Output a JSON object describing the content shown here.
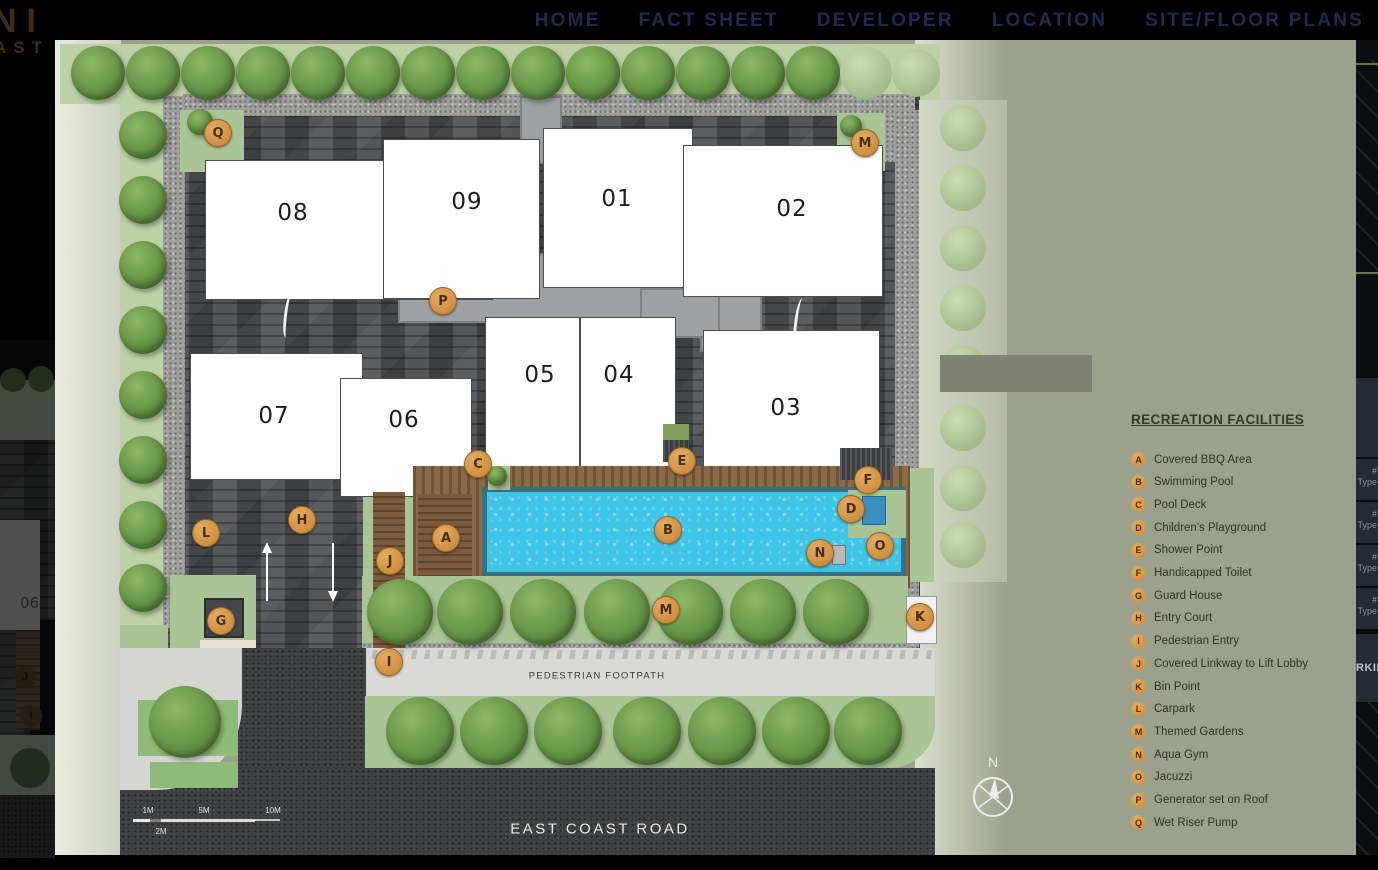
{
  "nav": {
    "items": [
      {
        "label": "HOME"
      },
      {
        "label": "FACT SHEET"
      },
      {
        "label": "DEVELOPER"
      },
      {
        "label": "LOCATION"
      },
      {
        "label": "SITE/FLOOR PLANS"
      }
    ]
  },
  "logo": {
    "top": "NI",
    "bottom": "AST"
  },
  "legend": {
    "title": "RECREATION FACILITIES",
    "items": [
      {
        "key": "A",
        "label": "Covered BBQ Area"
      },
      {
        "key": "B",
        "label": "Swimming Pool"
      },
      {
        "key": "C",
        "label": "Pool Deck"
      },
      {
        "key": "D",
        "label": "Children's Playground"
      },
      {
        "key": "E",
        "label": "Shower Point"
      },
      {
        "key": "F",
        "label": "Handicapped Toilet"
      },
      {
        "key": "G",
        "label": "Guard House"
      },
      {
        "key": "H",
        "label": "Entry Court"
      },
      {
        "key": "I",
        "label": "Pedestrian Entry"
      },
      {
        "key": "J",
        "label": "Covered Linkway to Lift Lobby"
      },
      {
        "key": "K",
        "label": "Bin Point"
      },
      {
        "key": "L",
        "label": "Carpark"
      },
      {
        "key": "M",
        "label": "Themed Gardens"
      },
      {
        "key": "N",
        "label": "Aqua Gym"
      },
      {
        "key": "O",
        "label": "Jacuzzi"
      },
      {
        "key": "P",
        "label": "Generator set on Roof"
      },
      {
        "key": "Q",
        "label": "Wet Riser Pump"
      }
    ]
  },
  "site_plan": {
    "buildings": [
      {
        "num": "08",
        "x": 205,
        "y": 160,
        "w": 288,
        "h": 140,
        "lx": 293,
        "ly": 213
      },
      {
        "num": "09",
        "x": 383,
        "y": 139,
        "w": 157,
        "h": 160,
        "lx": 467,
        "ly": 202
      },
      {
        "num": "01",
        "x": 543,
        "y": 128,
        "w": 150,
        "h": 160,
        "lx": 617,
        "ly": 199
      },
      {
        "num": "02",
        "x": 683,
        "y": 145,
        "w": 200,
        "h": 152,
        "lx": 792,
        "ly": 209
      },
      {
        "num": "07",
        "x": 190,
        "y": 353,
        "w": 173,
        "h": 127,
        "lx": 274,
        "ly": 416
      },
      {
        "num": "06",
        "x": 340,
        "y": 378,
        "w": 132,
        "h": 119,
        "lx": 404,
        "ly": 420
      },
      {
        "num": "05",
        "x": 485,
        "y": 317,
        "w": 95,
        "h": 183,
        "lx": 540,
        "ly": 375
      },
      {
        "num": "04",
        "x": 580,
        "y": 317,
        "w": 96,
        "h": 183,
        "lx": 619,
        "ly": 375
      },
      {
        "num": "03",
        "x": 703,
        "y": 330,
        "w": 177,
        "h": 148,
        "lx": 786,
        "ly": 408
      }
    ],
    "markers": [
      {
        "key": "Q",
        "x": 218,
        "y": 133
      },
      {
        "key": "M",
        "x": 865,
        "y": 143
      },
      {
        "key": "P",
        "x": 443,
        "y": 301
      },
      {
        "key": "C",
        "x": 478,
        "y": 464
      },
      {
        "key": "E",
        "x": 682,
        "y": 461
      },
      {
        "key": "F",
        "x": 868,
        "y": 480
      },
      {
        "key": "D",
        "x": 851,
        "y": 509
      },
      {
        "key": "A",
        "x": 446,
        "y": 538
      },
      {
        "key": "B",
        "x": 668,
        "y": 530
      },
      {
        "key": "N",
        "x": 820,
        "y": 553
      },
      {
        "key": "O",
        "x": 880,
        "y": 546
      },
      {
        "key": "L",
        "x": 206,
        "y": 533
      },
      {
        "key": "H",
        "x": 302,
        "y": 520
      },
      {
        "key": "J",
        "x": 390,
        "y": 561
      },
      {
        "key": "G",
        "x": 221,
        "y": 621
      },
      {
        "key": "K",
        "x": 920,
        "y": 617
      },
      {
        "key": "I",
        "x": 389,
        "y": 662
      },
      {
        "key": "M",
        "x": 666,
        "y": 610
      }
    ],
    "labels": {
      "footpath": "PEDESTRIAN FOOTPATH",
      "road": "EAST COAST ROAD",
      "compass": "N"
    },
    "scale_bar": {
      "ticks": [
        "1M",
        "5M",
        "10M"
      ],
      "sub_tick": "2M"
    }
  },
  "previous_slide": {
    "building": "06",
    "markers": [
      "J",
      "I"
    ]
  },
  "side_panel": {
    "rows": [
      {
        "line1": "#",
        "line2": "Type"
      },
      {
        "line1": "#",
        "line2": "Type"
      },
      {
        "line1": "#",
        "line2": "Type"
      },
      {
        "line1": "#",
        "line2": "Type"
      }
    ],
    "parking_label": "RKIN"
  },
  "colors": {
    "accent_orange": "#d9a25c",
    "panel_olive": "#9ba18c",
    "pool_blue": "#3ec4e6",
    "nav_text": "#20294e"
  }
}
